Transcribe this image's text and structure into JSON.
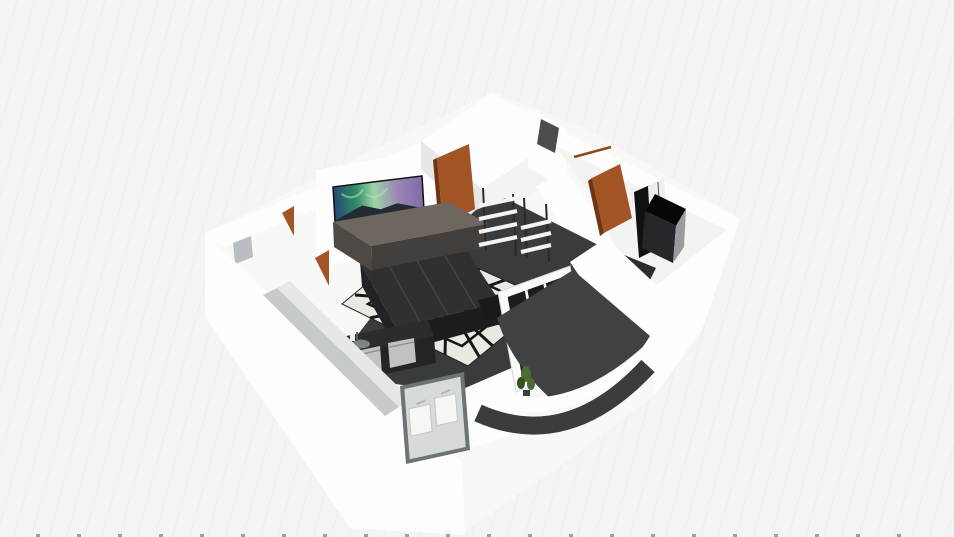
{
  "scene": {
    "type": "3d-floorplan-render",
    "description": "Isometric 3D floor plan of an apartment: living room with TV, sofa and patterned rug, kitchen corner, wardrobe room, french door to a curved balcony",
    "objects": [
      "exterior-walls",
      "tv-screen",
      "tv-cabinet",
      "living-room-door",
      "sofa",
      "zebra-rug",
      "jute-rug",
      "coffee-table",
      "kitchen-counter",
      "kitchen-appliances",
      "kitchen-sink",
      "ladder-shelf",
      "ladder-shelf-2",
      "wall-mirror",
      "curtain-rail",
      "bedroom-door",
      "wardrobe-white",
      "wardrobe-black",
      "hall-floor",
      "front-window",
      "left-wall-window",
      "french-door",
      "balcony-floor",
      "balcony-parapet",
      "balcony-plant"
    ]
  },
  "palette": {
    "bg": "#f0f0ef",
    "hull": "#f8f8f7",
    "wall_white": "#fdfdfd",
    "wall_light": "#f3f3f1",
    "wall_shade": "#e7e7e5",
    "wall_top_gray": "#c7cacb",
    "window_patch": "#b9bdbf",
    "floor_dark": "#3a3b3d",
    "floor_darker": "#2c2d2f",
    "rug_white": "#eae8e2",
    "rug_black": "#161616",
    "jute": "#c7ae87",
    "jute_line": "#a8906c",
    "sofa_top": "#303032",
    "sofa_front": "#232325",
    "sofa_front2": "#1c1c1e",
    "sofa_seam": "#47474a",
    "cabinet_top": "#6e6760",
    "cabinet_front": "#4e4945",
    "cabinet_side": "#433f3c",
    "table_black": "#1a1a1c",
    "counter_dark": "#2b2c2e",
    "counter_front": "#232426",
    "appliance": "#bfc3c4",
    "appliance_dark": "#8e9395",
    "steel": "#7d8284",
    "door_brown": "#a35424",
    "door_brown_dark": "#6f3414",
    "door_rail": "#8a4a1e",
    "wardrobe_black": "#101113",
    "wardrobe_dark": "#26272a",
    "wardrobe_gray": "#9b9b9d",
    "wardrobe_white": "#eeeeee",
    "wardrobe_top": "#060708",
    "mirror_dark": "#4a4c4e",
    "shelf_white": "#f4f4f4",
    "shelf_pole": "#2a2a2c",
    "frame_gray": "#6e7476",
    "window_inner": "#d7dadb",
    "sash_white": "#f6f6f5",
    "door_glass": "#1c1d1f",
    "door_frame": "#fafafa",
    "balcony_floor": "#3f4143",
    "balcony_band": "#3a3c3e",
    "plant_green": "#4c6b35",
    "plant_dark": "#35511f",
    "pot_dark": "#3c3c3c",
    "tv_g1": "#254a73",
    "tv_g2": "#2f8b66",
    "tv_g3": "#9ed4a6",
    "tv_g4": "#9a86b5",
    "tv_g5": "#7e6ca6",
    "tv_mountain": "#242a32",
    "tv_streak": "#b8f0c8",
    "bezel": "#0f1116",
    "knob": "#c9c9c9",
    "outline_soft": "#d8d8d8"
  }
}
